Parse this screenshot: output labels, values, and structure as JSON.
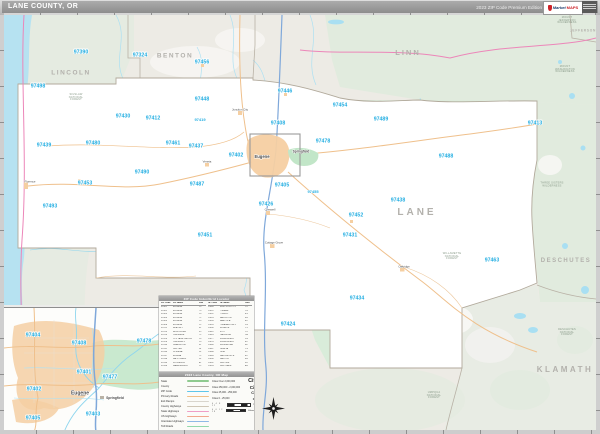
{
  "header": {
    "title": "LANE COUNTY, OR",
    "edition": "2023 ZIP Code Premium Edition",
    "logo_text_1": "Market",
    "logo_text_2": "MAPS"
  },
  "colors": {
    "zip_label": "#23aee2",
    "ocean": "#b6e2f1",
    "county_fill": "#ffffff",
    "forest_green": "#d9ecda",
    "urban_orange": "#f5cfa2",
    "interstate_blue": "#7fa8da",
    "state_highway_pink": "#ec86b9"
  },
  "map": {
    "county_labels": [
      {
        "t": "LINCOLN",
        "x": 71,
        "y": 74,
        "s": 6.5,
        "ls": 1.5
      },
      {
        "t": "BENTON",
        "x": 175,
        "y": 57,
        "s": 6.5,
        "ls": 1.5
      },
      {
        "t": "LINN",
        "x": 408,
        "y": 53,
        "s": 7.5,
        "ls": 2
      },
      {
        "t": "JEFFERSON",
        "x": 583,
        "y": 31,
        "s": 3.2,
        "ls": 0.8
      },
      {
        "t": "LANE",
        "x": 417,
        "y": 213,
        "s": 10,
        "ls": 3
      },
      {
        "t": "DESCHUTES",
        "x": 566,
        "y": 261,
        "s": 6,
        "ls": 1.5
      },
      {
        "t": "KLAMATH",
        "x": 565,
        "y": 370,
        "s": 8,
        "ls": 2.5
      }
    ],
    "zip_labels": [
      {
        "t": "97390",
        "x": 81,
        "y": 53
      },
      {
        "t": "97324",
        "x": 140,
        "y": 56
      },
      {
        "t": "97456",
        "x": 202,
        "y": 63
      },
      {
        "t": "97498",
        "x": 38,
        "y": 87
      },
      {
        "t": "97446",
        "x": 285,
        "y": 92
      },
      {
        "t": "97448",
        "x": 202,
        "y": 100
      },
      {
        "t": "97454",
        "x": 340,
        "y": 106
      },
      {
        "t": "97430",
        "x": 123,
        "y": 117
      },
      {
        "t": "97412",
        "x": 153,
        "y": 119
      },
      {
        "t": "97419",
        "x": 200,
        "y": 120,
        "s": 4
      },
      {
        "t": "97408",
        "x": 278,
        "y": 124
      },
      {
        "t": "97489",
        "x": 381,
        "y": 120
      },
      {
        "t": "97413",
        "x": 535,
        "y": 124
      },
      {
        "t": "97478",
        "x": 323,
        "y": 142
      },
      {
        "t": "97461",
        "x": 173,
        "y": 144
      },
      {
        "t": "97480",
        "x": 93,
        "y": 144
      },
      {
        "t": "97439",
        "x": 44,
        "y": 146
      },
      {
        "t": "97437",
        "x": 196,
        "y": 147
      },
      {
        "t": "97402",
        "x": 236,
        "y": 156
      },
      {
        "t": "97488",
        "x": 446,
        "y": 157
      },
      {
        "t": "97490",
        "x": 142,
        "y": 173
      },
      {
        "t": "97453",
        "x": 85,
        "y": 184
      },
      {
        "t": "97487",
        "x": 197,
        "y": 185
      },
      {
        "t": "97405",
        "x": 282,
        "y": 186
      },
      {
        "t": "97455",
        "x": 313,
        "y": 192,
        "s": 4
      },
      {
        "t": "97438",
        "x": 398,
        "y": 201
      },
      {
        "t": "97426",
        "x": 266,
        "y": 205
      },
      {
        "t": "97493",
        "x": 50,
        "y": 207
      },
      {
        "t": "97452",
        "x": 356,
        "y": 216
      },
      {
        "t": "97451",
        "x": 205,
        "y": 236
      },
      {
        "t": "97431",
        "x": 350,
        "y": 236
      },
      {
        "t": "97463",
        "x": 492,
        "y": 261
      },
      {
        "t": "97434",
        "x": 357,
        "y": 299
      },
      {
        "t": "97424",
        "x": 288,
        "y": 325
      }
    ],
    "area_labels": [
      {
        "t": "SIUSLAW\nNATIONAL\nFOREST",
        "x": 76,
        "y": 98
      },
      {
        "t": "MOUNT\nJEFFERSON\nWILDERNESS",
        "x": 567,
        "y": 21
      },
      {
        "t": "MOUNT\nWASHINGTON\nWILDERNESS",
        "x": 565,
        "y": 70
      },
      {
        "t": "THREE SISTERS\nWILDERNESS",
        "x": 552,
        "y": 185
      },
      {
        "t": "WILLAMETTE\nNATIONAL\nFOREST",
        "x": 452,
        "y": 257
      },
      {
        "t": "DESCHUTES\nNATIONAL\nFOREST",
        "x": 567,
        "y": 333
      },
      {
        "t": "UMPQUA\nNATIONAL\nFOREST",
        "x": 434,
        "y": 396
      }
    ],
    "town_labels": [
      {
        "t": "Eugene",
        "x": 262,
        "y": 157,
        "s": 4.2,
        "b": 1
      },
      {
        "t": "Springfield",
        "x": 301,
        "y": 152,
        "s": 3.2,
        "b": 1
      },
      {
        "t": "Junction City",
        "x": 240,
        "y": 110
      },
      {
        "t": "Veneta",
        "x": 207,
        "y": 162
      },
      {
        "t": "Creswell",
        "x": 270,
        "y": 210
      },
      {
        "t": "Cottage Grove",
        "x": 274,
        "y": 243
      },
      {
        "t": "Oakridge",
        "x": 404,
        "y": 267
      },
      {
        "t": "Florence",
        "x": 30,
        "y": 182
      }
    ]
  },
  "inset": {
    "zip_labels": [
      {
        "t": "97404",
        "x": 32,
        "y": 335
      },
      {
        "t": "97408",
        "x": 78,
        "y": 343
      },
      {
        "t": "97478",
        "x": 143,
        "y": 341
      },
      {
        "t": "97401",
        "x": 83,
        "y": 372
      },
      {
        "t": "97477",
        "x": 109,
        "y": 377
      },
      {
        "t": "97402",
        "x": 33,
        "y": 389
      },
      {
        "t": "97403",
        "x": 92,
        "y": 414
      },
      {
        "t": "97405",
        "x": 32,
        "y": 418
      }
    ],
    "town_labels": [
      {
        "t": "Eugene",
        "x": 79,
        "y": 393,
        "s": 5,
        "b": 1
      },
      {
        "t": "Springfield",
        "x": 114,
        "y": 398,
        "s": 3.4,
        "b": 1
      }
    ]
  },
  "index_panel": {
    "title": "ZIP Code Index/Grid Locator",
    "columns": [
      "ZIP Code",
      "ZIP Name",
      "Grid"
    ],
    "entries": [
      {
        "zip": "97401",
        "name": "EUGENE",
        "grid": "D3"
      },
      {
        "zip": "97402",
        "name": "EUGENE",
        "grid": "C3"
      },
      {
        "zip": "97403",
        "name": "EUGENE",
        "grid": "D3"
      },
      {
        "zip": "97404",
        "name": "EUGENE",
        "grid": "C2"
      },
      {
        "zip": "97405",
        "name": "EUGENE",
        "grid": "D3"
      },
      {
        "zip": "97408",
        "name": "EUGENE",
        "grid": "D2"
      },
      {
        "zip": "97412",
        "name": "BLACHLY",
        "grid": "B2"
      },
      {
        "zip": "97413",
        "name": "BLUE RIVER",
        "grid": "G2"
      },
      {
        "zip": "97419",
        "name": "CHESHIRE",
        "grid": "C2"
      },
      {
        "zip": "97424",
        "name": "COTTAGE GROVE",
        "grid": "D5"
      },
      {
        "zip": "97426",
        "name": "CRESWELL",
        "grid": "D3"
      },
      {
        "zip": "97430",
        "name": "DEADWOOD",
        "grid": "B2"
      },
      {
        "zip": "97431",
        "name": "DEXTER",
        "grid": "E4"
      },
      {
        "zip": "97434",
        "name": "DORENA",
        "grid": "E5"
      },
      {
        "zip": "97437",
        "name": "ELMIRA",
        "grid": "C2"
      },
      {
        "zip": "97438",
        "name": "FALL CREEK",
        "grid": "E3"
      },
      {
        "zip": "97439",
        "name": "FLORENCE",
        "grid": "A2"
      },
      {
        "zip": "97446",
        "name": "HARRISBURG",
        "grid": "D2"
      },
      {
        "zip": "97448",
        "name": "JUNCTION CITY",
        "grid": "C2"
      },
      {
        "zip": "97451",
        "name": "LORANE",
        "grid": "C4"
      },
      {
        "zip": "97452",
        "name": "LOWELL",
        "grid": "E3"
      },
      {
        "zip": "97453",
        "name": "MAPLETON",
        "grid": "B3"
      },
      {
        "zip": "97454",
        "name": "MARCOLA",
        "grid": "E2"
      },
      {
        "zip": "97455",
        "name": "PLEASANT HILL",
        "grid": "D3"
      },
      {
        "zip": "97456",
        "name": "MONROE",
        "grid": "C1"
      },
      {
        "zip": "97461",
        "name": "NOTI",
        "grid": "C2"
      },
      {
        "zip": "97463",
        "name": "OAKRIDGE",
        "grid": "G4"
      },
      {
        "zip": "97477",
        "name": "SPRINGFIELD",
        "grid": "D3"
      },
      {
        "zip": "97478",
        "name": "SPRINGFIELD",
        "grid": "E2"
      },
      {
        "zip": "97480",
        "name": "SWISSHOME",
        "grid": "B2"
      },
      {
        "zip": "97487",
        "name": "VENETA",
        "grid": "C3"
      },
      {
        "zip": "97488",
        "name": "VIDA",
        "grid": "F2"
      },
      {
        "zip": "97489",
        "name": "WALTERVILLE",
        "grid": "E2"
      },
      {
        "zip": "97490",
        "name": "WALTON",
        "grid": "B3"
      },
      {
        "zip": "97492",
        "name": "WESTFIR",
        "grid": "F4"
      },
      {
        "zip": "97493",
        "name": "WESTLAKE",
        "grid": "A3"
      }
    ]
  },
  "legend": {
    "title": "2023 Lane County, OR Map",
    "line_items": [
      {
        "label": "State",
        "color": "#8fca8f"
      },
      {
        "label": "County",
        "color": "#b2ada3"
      },
      {
        "label": "ZIP Code",
        "color": "#5ec6ea"
      },
      {
        "label": "Primary Roads",
        "color": "#f0c089"
      },
      {
        "label": "Exit Ramps",
        "color": "#d9d5cd"
      },
      {
        "label": "County Highways",
        "color": "#cfc6b6"
      },
      {
        "label": "State Highways",
        "color": "#ef9ec7"
      },
      {
        "label": "US Highways",
        "color": "#f2a88e"
      },
      {
        "label": "Interstate Highways",
        "color": "#8fb9e6"
      },
      {
        "label": "Toll Roads",
        "color": "#93d9ab"
      }
    ],
    "city_items": [
      {
        "label": "Cities Over 2,000,000",
        "sample": "City"
      },
      {
        "label": "Cities 250,000 - 2,000,000",
        "sample": "City"
      },
      {
        "label": "Cities 25,000 - 250,000",
        "sample": "City"
      },
      {
        "label": "Cities 0 - 25,000",
        "sample": "City"
      }
    ],
    "scale": {
      "miles_label": "Miles",
      "miles_ticks": [
        "0",
        "4",
        "8",
        "12"
      ],
      "km_label": "Kilometers",
      "km_ticks": [
        "0",
        "6",
        "12",
        "18"
      ]
    }
  }
}
